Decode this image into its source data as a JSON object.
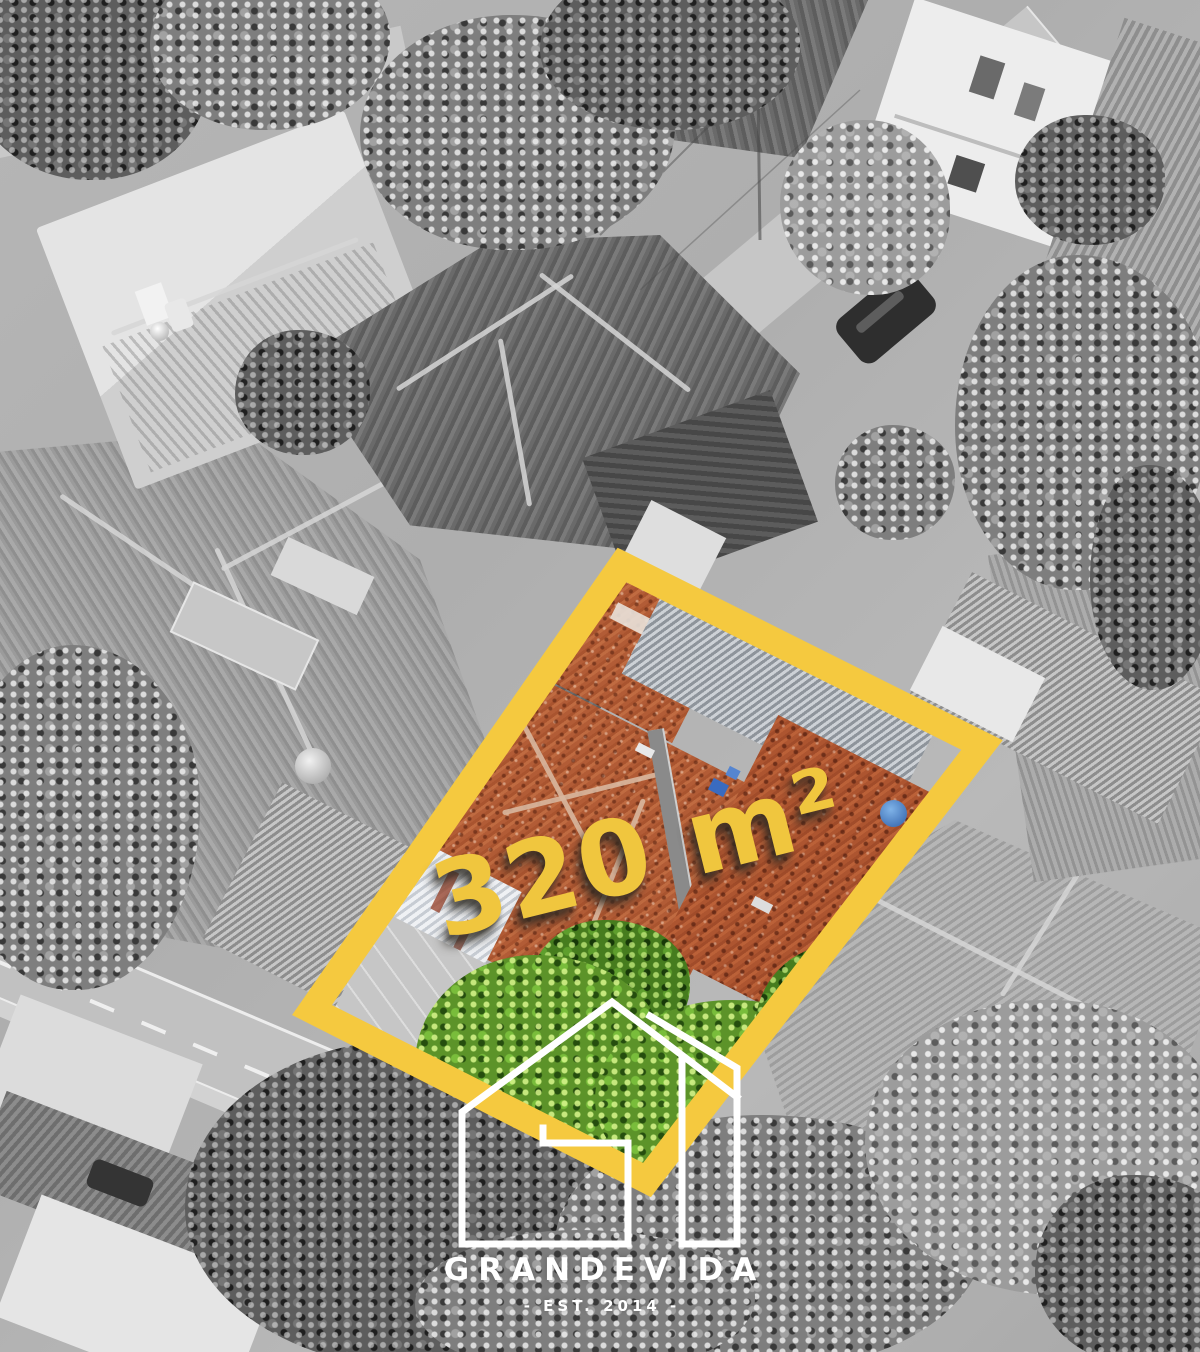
{
  "overlay": {
    "area_label": "320 m²",
    "highlight_color": "#F5C93F"
  },
  "brand": {
    "name": "GRANDEVIDA",
    "established": "- EST. 2014 -",
    "logo_icon": "house-outline-logo",
    "text_color": "#FFFFFF"
  },
  "photo": {
    "plot_roof_color": "#B25C36",
    "plot_foliage_color": "#6FB033"
  }
}
